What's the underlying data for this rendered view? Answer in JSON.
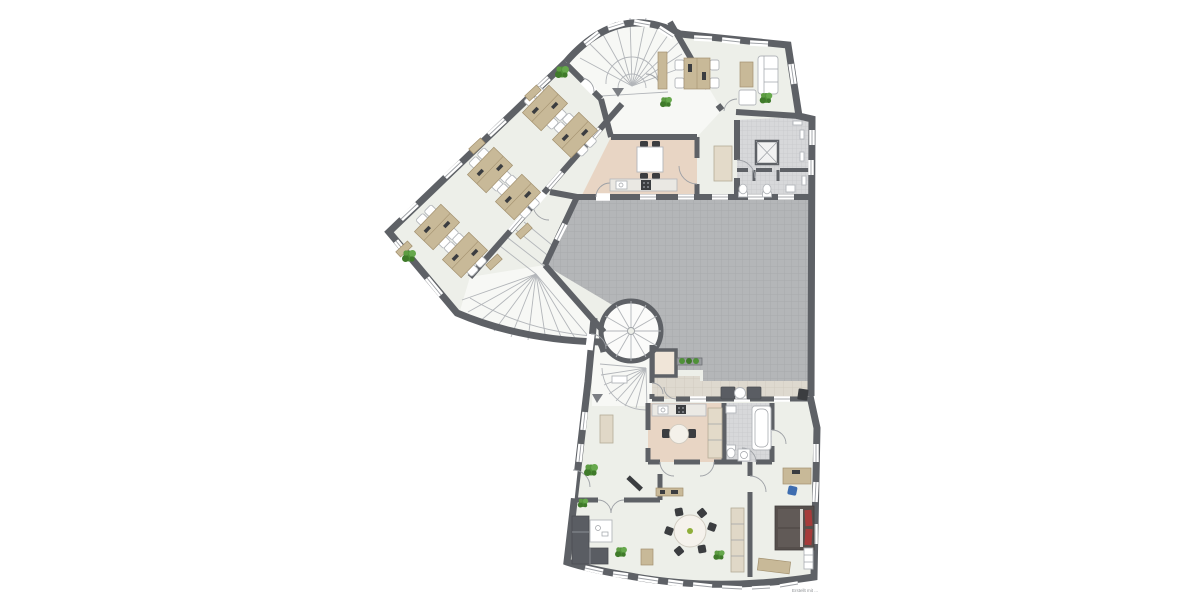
{
  "meta": {
    "document_type": "architectural floor plan",
    "watermark": "Erstellt mit ...",
    "scale_text_visible": false
  },
  "palette": {
    "wall": "#5e6166",
    "wallLight": "#9da0a5",
    "floor": "#edefe9",
    "floorHall": "#f7f8f5",
    "warm": "#e8d5c4",
    "warmLight": "#f0e5d8",
    "terrace": "#b4b6b8",
    "terraceLine": "#a6a8aa",
    "mosaic": "#d7d8da",
    "mosaicLine": "#c7c8cb",
    "walkway": "#ded9cf",
    "walkwayLine": "#cfc9bd",
    "wood": "#c8b998",
    "woodDark": "#a3916f",
    "sofa": "#5a5d63",
    "dark": "#3b3d40",
    "bed": "#564f4c",
    "red": "#a63b3b",
    "plant": "#4f9138",
    "plantDark": "#3f7a2a",
    "blue": "#3e6db0",
    "stair": "#b3b6ba",
    "arrow": "#7b7e83"
  },
  "rooms": [
    {
      "id": "open-plan-office",
      "floor": "floor",
      "contents": "6 team workstations, wall sideboards, 2 plants"
    },
    {
      "id": "meeting-office",
      "floor": "floor",
      "contents": "desk with 4 chairs, sideboard, sofa, coffee table, armchair, plant"
    },
    {
      "id": "main-stair-hall",
      "floor": "floorHall",
      "contents": "curved main staircase, down arrow, 2 plants"
    },
    {
      "id": "break-kitchen",
      "floor": "warm",
      "contents": "table with 4 chairs, kitchenette with sink and hob, tall cabinet"
    },
    {
      "id": "corridor",
      "floor": "floor",
      "contents": ""
    },
    {
      "id": "wc-area",
      "floor": "mosaic",
      "contents": "2 WCs, sink, ventilation shaft, 4 radiators"
    },
    {
      "id": "roof-terrace",
      "floor": "terrace",
      "contents": "planter bench"
    },
    {
      "id": "terrace-walkway",
      "floor": "walkway",
      "contents": "2 lounge mats, round side table, grill"
    },
    {
      "id": "winding-stair-hall",
      "floor": "floorHall",
      "contents": "winding staircase"
    },
    {
      "id": "spiral-stair-tower",
      "floor": "floorHall",
      "contents": "spiral staircase"
    },
    {
      "id": "storage",
      "floor": "warmLight",
      "contents": ""
    },
    {
      "id": "apartment-hall",
      "floor": "floorHall",
      "contents": "winding stair, wardrobe, down arrow"
    },
    {
      "id": "apartment-kitchen",
      "floor": "warm",
      "contents": "kitchenette, tall unit, round table with 2 chairs"
    },
    {
      "id": "bathroom",
      "floor": "mosaic",
      "contents": "bathtub, WC, washbasin, washing machine"
    },
    {
      "id": "bedroom",
      "floor": "floor",
      "contents": "double bed with red pillows, wardrobe, desk with blue chair, bench"
    },
    {
      "id": "living-dining-room",
      "floor": "floor",
      "contents": "L-sofa, coffee table, TV, wall shelf, round dining table with 6 chairs, sideboard, 4 plants"
    }
  ],
  "stairs": [
    "curved-main-staircase",
    "winding-staircase",
    "spiral-staircase",
    "apartment-winding-staircase"
  ],
  "counts": {
    "workstations": 6,
    "plants": 9,
    "direction_arrows": 2,
    "windows_approx": 40
  }
}
